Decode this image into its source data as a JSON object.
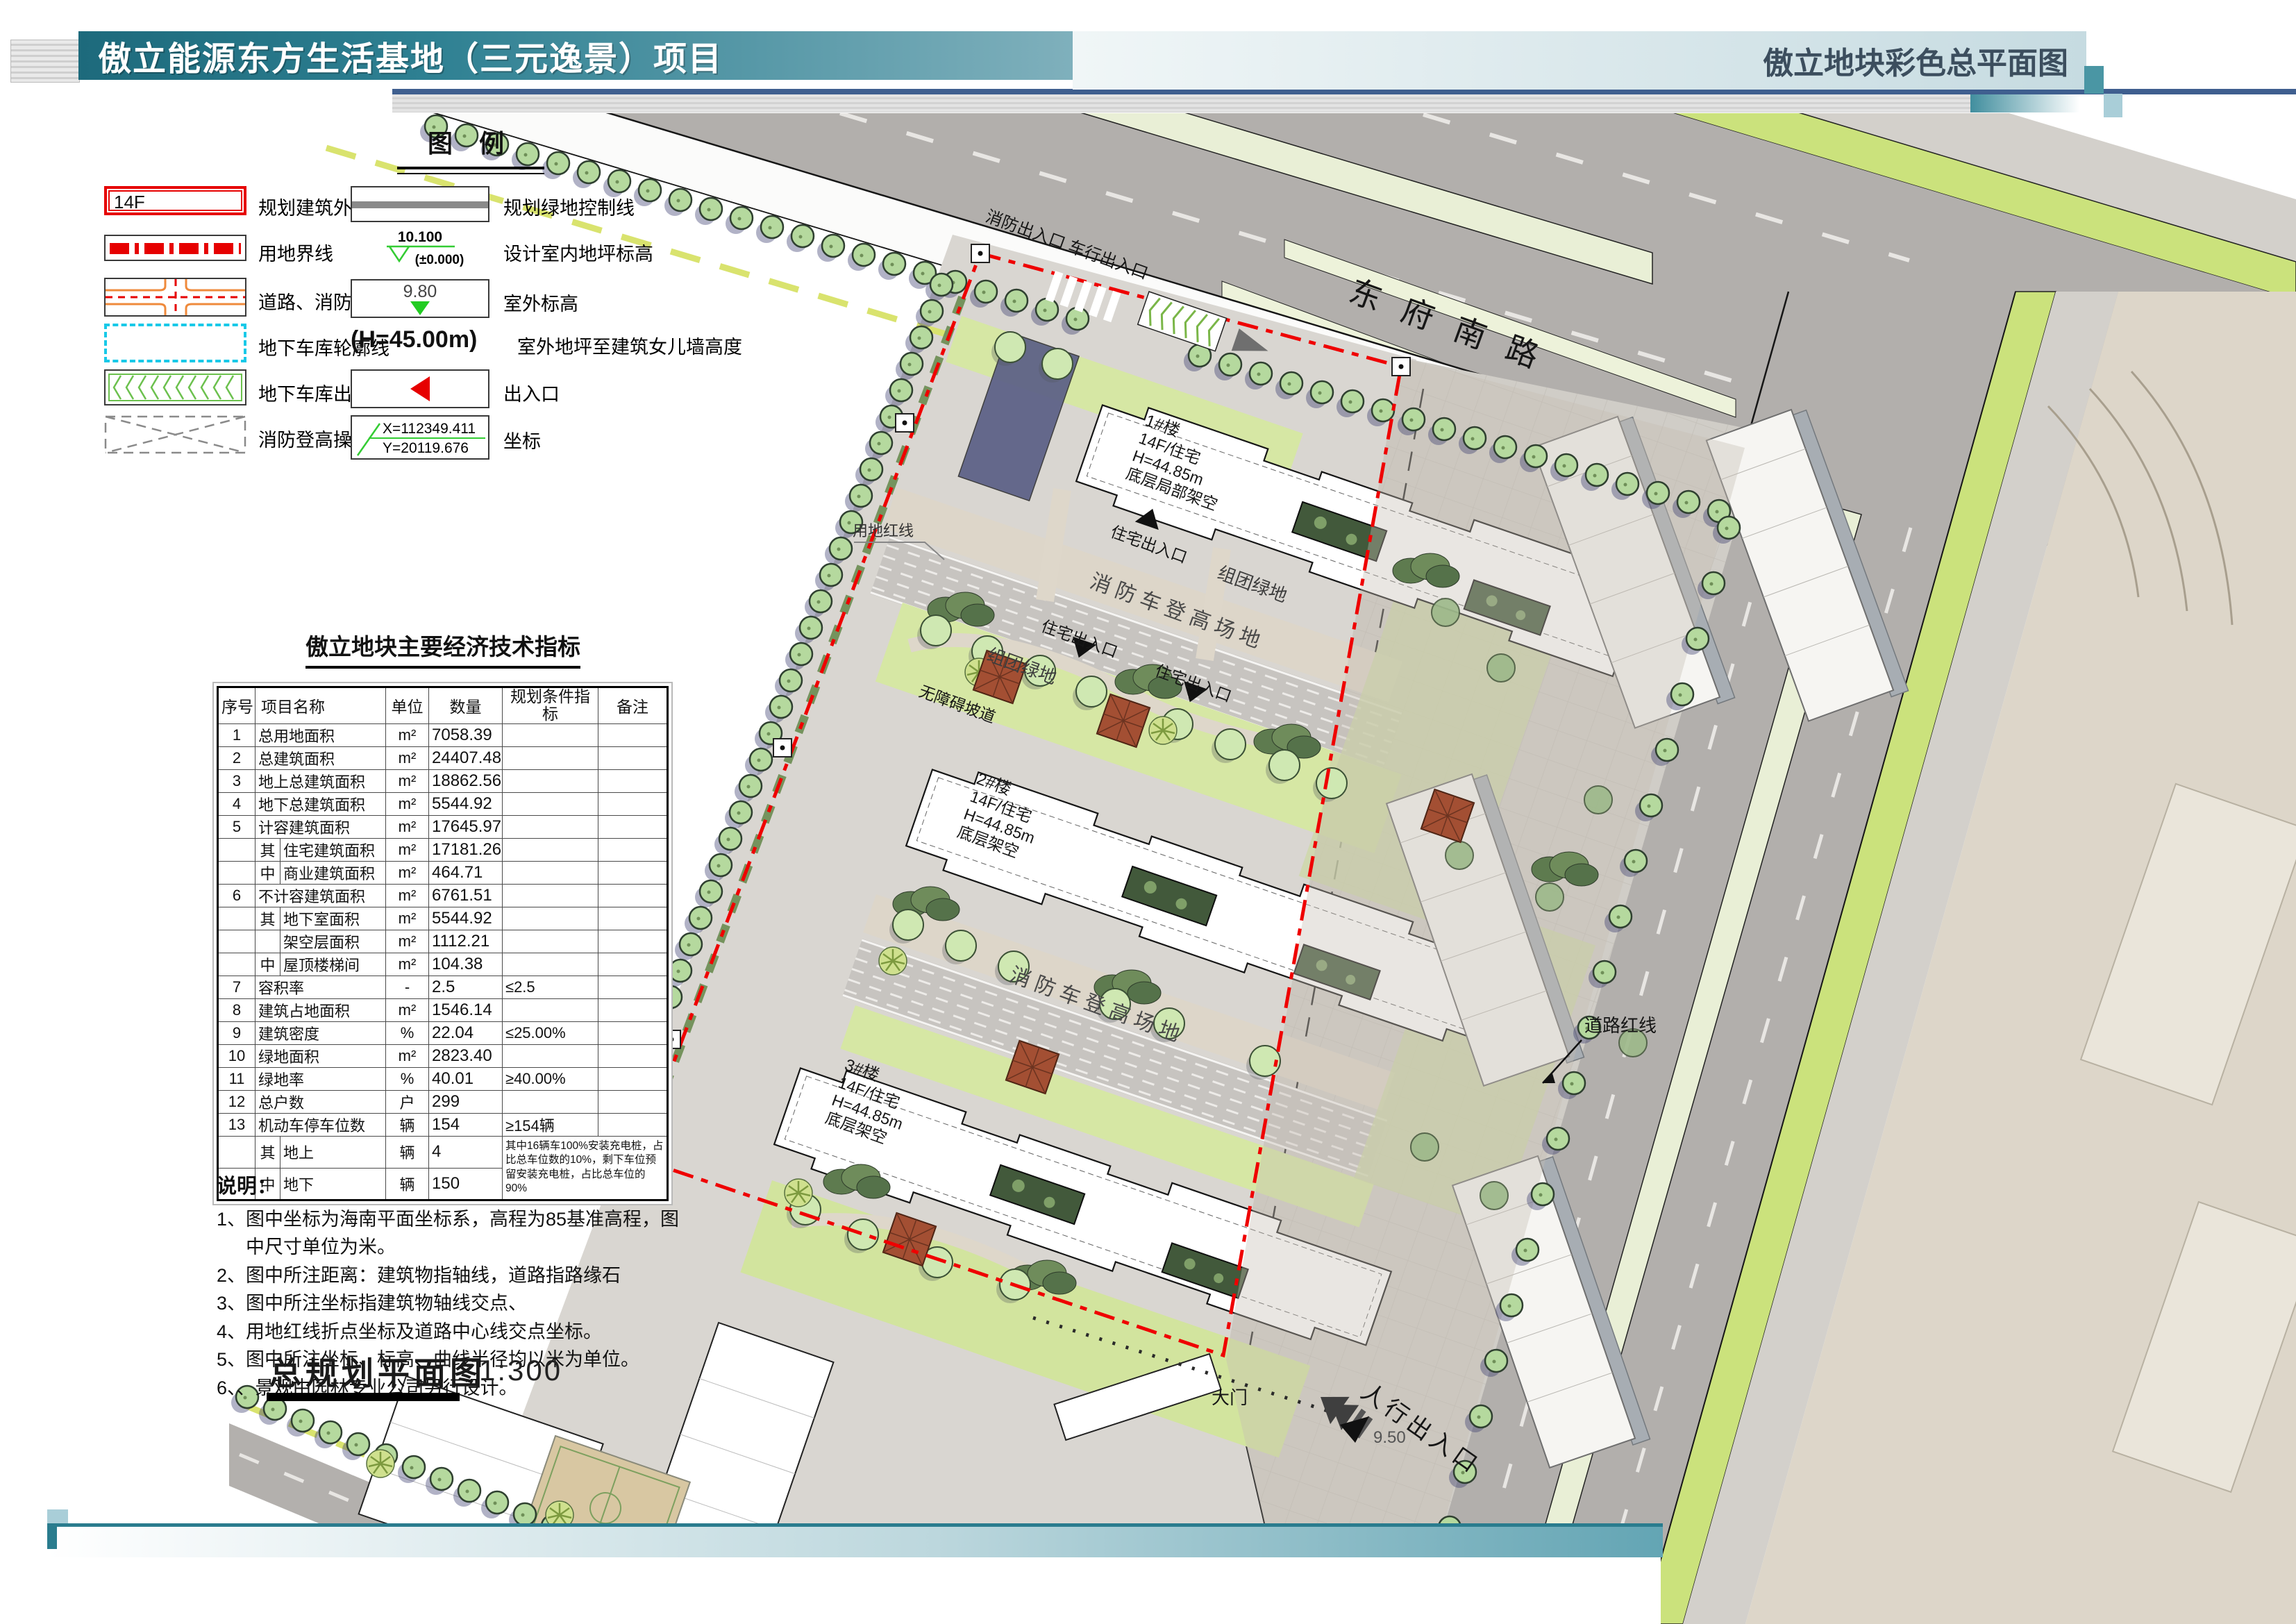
{
  "header": {
    "title": "傲立能源东方生活基地（三元逸景）项目",
    "subtitle": "傲立地块彩色总平面图"
  },
  "legend": {
    "title": "图  例",
    "left": [
      {
        "icon": "building-outline-symbol",
        "symbol_text": "14F",
        "label": "规划建筑外墙线及层数"
      },
      {
        "icon": "site-boundary-symbol",
        "label": "用地界线"
      },
      {
        "icon": "road-symbol",
        "label": "道路、消防车道"
      },
      {
        "icon": "garage-outline-symbol",
        "label": "地下车库轮廓线"
      },
      {
        "icon": "garage-entrance-symbol",
        "label": "地下车库出入口"
      },
      {
        "icon": "fire-operation-symbol",
        "label": "消防登高操作场地"
      }
    ],
    "right": [
      {
        "icon": "green-control-line-symbol",
        "label": "规划绿地控制线"
      },
      {
        "icon": "indoor-elevation-symbol",
        "symbol_text": "10.100",
        "symbol_text2": "(±0.000)",
        "label": "设计室内地坪标高"
      },
      {
        "icon": "outdoor-elevation-symbol",
        "symbol_text": "9.80",
        "label": "室外标高"
      },
      {
        "icon": "height-symbol",
        "symbol_text": "(H=45.00m)",
        "label": "室外地坪至建筑女儿墙高度"
      },
      {
        "icon": "entrance-symbol",
        "label": "出入口"
      },
      {
        "icon": "coordinate-symbol",
        "symbol_text": "X=112349.411",
        "symbol_text2": "Y=20119.676",
        "label": "坐标"
      }
    ]
  },
  "table": {
    "title": "傲立地块主要经济技术指标",
    "headers": [
      "序号",
      "项目名称",
      "单位",
      "数量",
      "规划条件指标",
      "备注"
    ],
    "rows": [
      {
        "no": "1",
        "sub": "",
        "name": "总用地面积",
        "unit": "m²",
        "qty": "7058.39",
        "plan": "",
        "note": ""
      },
      {
        "no": "2",
        "sub": "",
        "name": "总建筑面积",
        "unit": "m²",
        "qty": "24407.48",
        "plan": "",
        "note": ""
      },
      {
        "no": "3",
        "sub": "",
        "name": "地上总建筑面积",
        "unit": "m²",
        "qty": "18862.56",
        "plan": "",
        "note": ""
      },
      {
        "no": "4",
        "sub": "",
        "name": "地下总建筑面积",
        "unit": "m²",
        "qty": "5544.92",
        "plan": "",
        "note": ""
      },
      {
        "no": "5",
        "sub": "",
        "name": "计容建筑面积",
        "unit": "m²",
        "qty": "17645.97",
        "plan": "",
        "note": ""
      },
      {
        "no": "",
        "sub": "其",
        "name": "住宅建筑面积",
        "unit": "m²",
        "qty": "17181.26",
        "plan": "",
        "note": ""
      },
      {
        "no": "",
        "sub": "中",
        "name": "商业建筑面积",
        "unit": "m²",
        "qty": "464.71",
        "plan": "",
        "note": ""
      },
      {
        "no": "6",
        "sub": "",
        "name": "不计容建筑面积",
        "unit": "m²",
        "qty": "6761.51",
        "plan": "",
        "note": ""
      },
      {
        "no": "",
        "sub": "其",
        "name": "地下室面积",
        "unit": "m²",
        "qty": "5544.92",
        "plan": "",
        "note": ""
      },
      {
        "no": "",
        "sub": "",
        "name": "架空层面积",
        "unit": "m²",
        "qty": "1112.21",
        "plan": "",
        "note": ""
      },
      {
        "no": "",
        "sub": "中",
        "name": "屋顶楼梯间",
        "unit": "m²",
        "qty": "104.38",
        "plan": "",
        "note": ""
      },
      {
        "no": "7",
        "sub": "",
        "name": "容积率",
        "unit": "-",
        "qty": "2.5",
        "plan": "≤2.5",
        "note": ""
      },
      {
        "no": "8",
        "sub": "",
        "name": "建筑占地面积",
        "unit": "m²",
        "qty": "1546.14",
        "plan": "",
        "note": ""
      },
      {
        "no": "9",
        "sub": "",
        "name": "建筑密度",
        "unit": "%",
        "qty": "22.04",
        "plan": "≤25.00%",
        "note": ""
      },
      {
        "no": "10",
        "sub": "",
        "name": "绿地面积",
        "unit": "m²",
        "qty": "2823.40",
        "plan": "",
        "note": ""
      },
      {
        "no": "11",
        "sub": "",
        "name": "绿地率",
        "unit": "%",
        "qty": "40.01",
        "plan": "≥40.00%",
        "note": ""
      },
      {
        "no": "12",
        "sub": "",
        "name": "总户数",
        "unit": "户",
        "qty": "299",
        "plan": "",
        "note": ""
      },
      {
        "no": "13",
        "sub": "",
        "name": "机动车停车位数",
        "unit": "辆",
        "qty": "154",
        "plan": "≥154辆",
        "note": ""
      },
      {
        "no": "",
        "sub": "其",
        "name": "地上",
        "unit": "辆",
        "qty": "4",
        "plan": "",
        "note": "其中16辆车100%安装充电桩，占比总车位数的10%，剩下车位预留安装充电桩，占比总车位的90%"
      },
      {
        "no": "",
        "sub": "中",
        "name": "地下",
        "unit": "辆",
        "qty": "150",
        "plan": "",
        "note": ""
      }
    ]
  },
  "notes": {
    "title": "说明：",
    "items": [
      "1、图中坐标为海南平面坐标系，高程为85基准高程，图中尺寸单位为米。",
      "2、图中所注距离：建筑物指轴线，道路指路缘石",
      "3、图中所注坐标指建筑物轴线交点、",
      "4、用地红线折点坐标及道路中心线交点坐标。",
      "5、图中所注坐标、标高、曲线半径均以米为单位。",
      "6、、景观由园林专业公司另行设计。"
    ]
  },
  "footer": {
    "title": "总规划平面图",
    "scale": "1:300"
  },
  "plan": {
    "road_name": "东府南路",
    "labels": {
      "entrance_top": "消防出入口 车行出入口",
      "fire_lane": "消防车登高场地",
      "group_green": "组团绿地",
      "residential_entrance": "住宅出入口",
      "barrier_free_ramp": "无障碍坡道",
      "site_red_line": "用地红线",
      "road_red_line": "道路红线",
      "gate": "大门",
      "pedestrian_entrance": "人行出入口",
      "elevation": "9.50"
    },
    "buildings": [
      {
        "name": "1#楼",
        "type": "14F/住宅",
        "height": "H=44.85m",
        "note": "底层局部架空"
      },
      {
        "name": "2#楼",
        "type": "14F/住宅",
        "height": "H=44.85m",
        "note": "底层架空"
      },
      {
        "name": "3#楼",
        "type": "14F/住宅",
        "height": "H=44.85m",
        "note": "底层架空"
      }
    ],
    "colors": {
      "boundary_red": "#e60000",
      "lawn": "#d6e7a4",
      "tree": "#b5d99e",
      "road": "#b2afac",
      "median": "#e9efd6",
      "verge": "#cbe27c",
      "accent_teal": "#2e8092",
      "navy": "#3f5f8f"
    }
  }
}
